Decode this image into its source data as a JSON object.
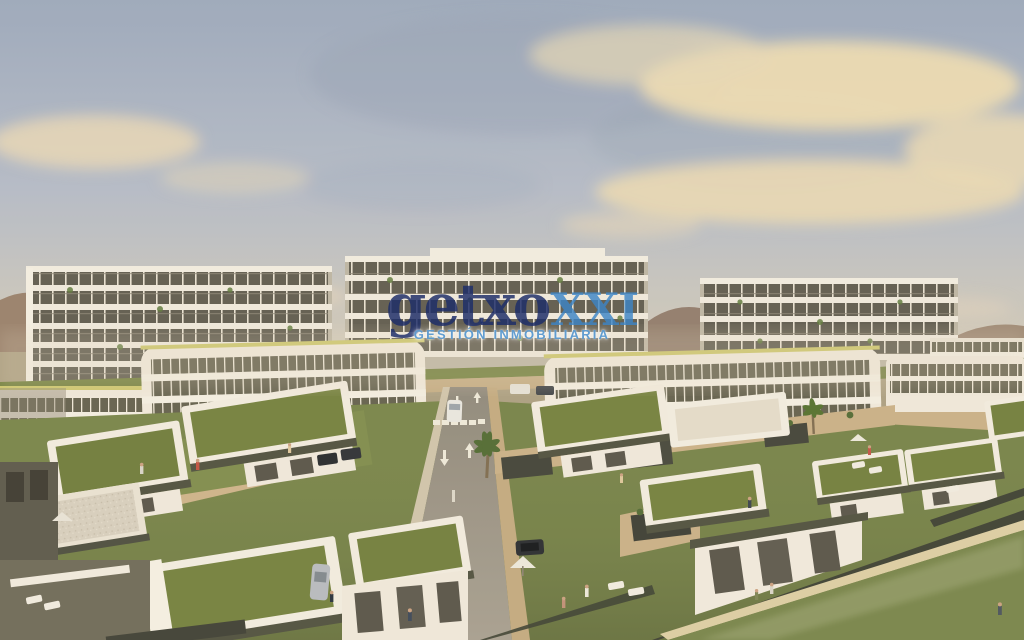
{
  "watermark": {
    "brand_primary": "getxo",
    "brand_suffix": "XXI",
    "tagline": "GESTIÓN INMOBILIARIA",
    "colors": {
      "primary": "#1e2d69",
      "suffix": "#3d85c6",
      "tagline": "#5c9ace"
    }
  },
  "scene": {
    "subject": "aerial render of residential development with apartment blocks, green-roof villas, road and gardens",
    "palette": {
      "sky_top": "#9aa9bf",
      "sky_horizon": "#ddd3c0",
      "cloud": "#ecdcb4",
      "building_white": "#f0ece1",
      "glazing": "#5d5b50",
      "green_roof": "#71803f",
      "lawn": "#76854b",
      "stone_wall": "#cdb48c",
      "road": "#99938a",
      "fence": "#3b4034",
      "field": "#76854c"
    }
  }
}
